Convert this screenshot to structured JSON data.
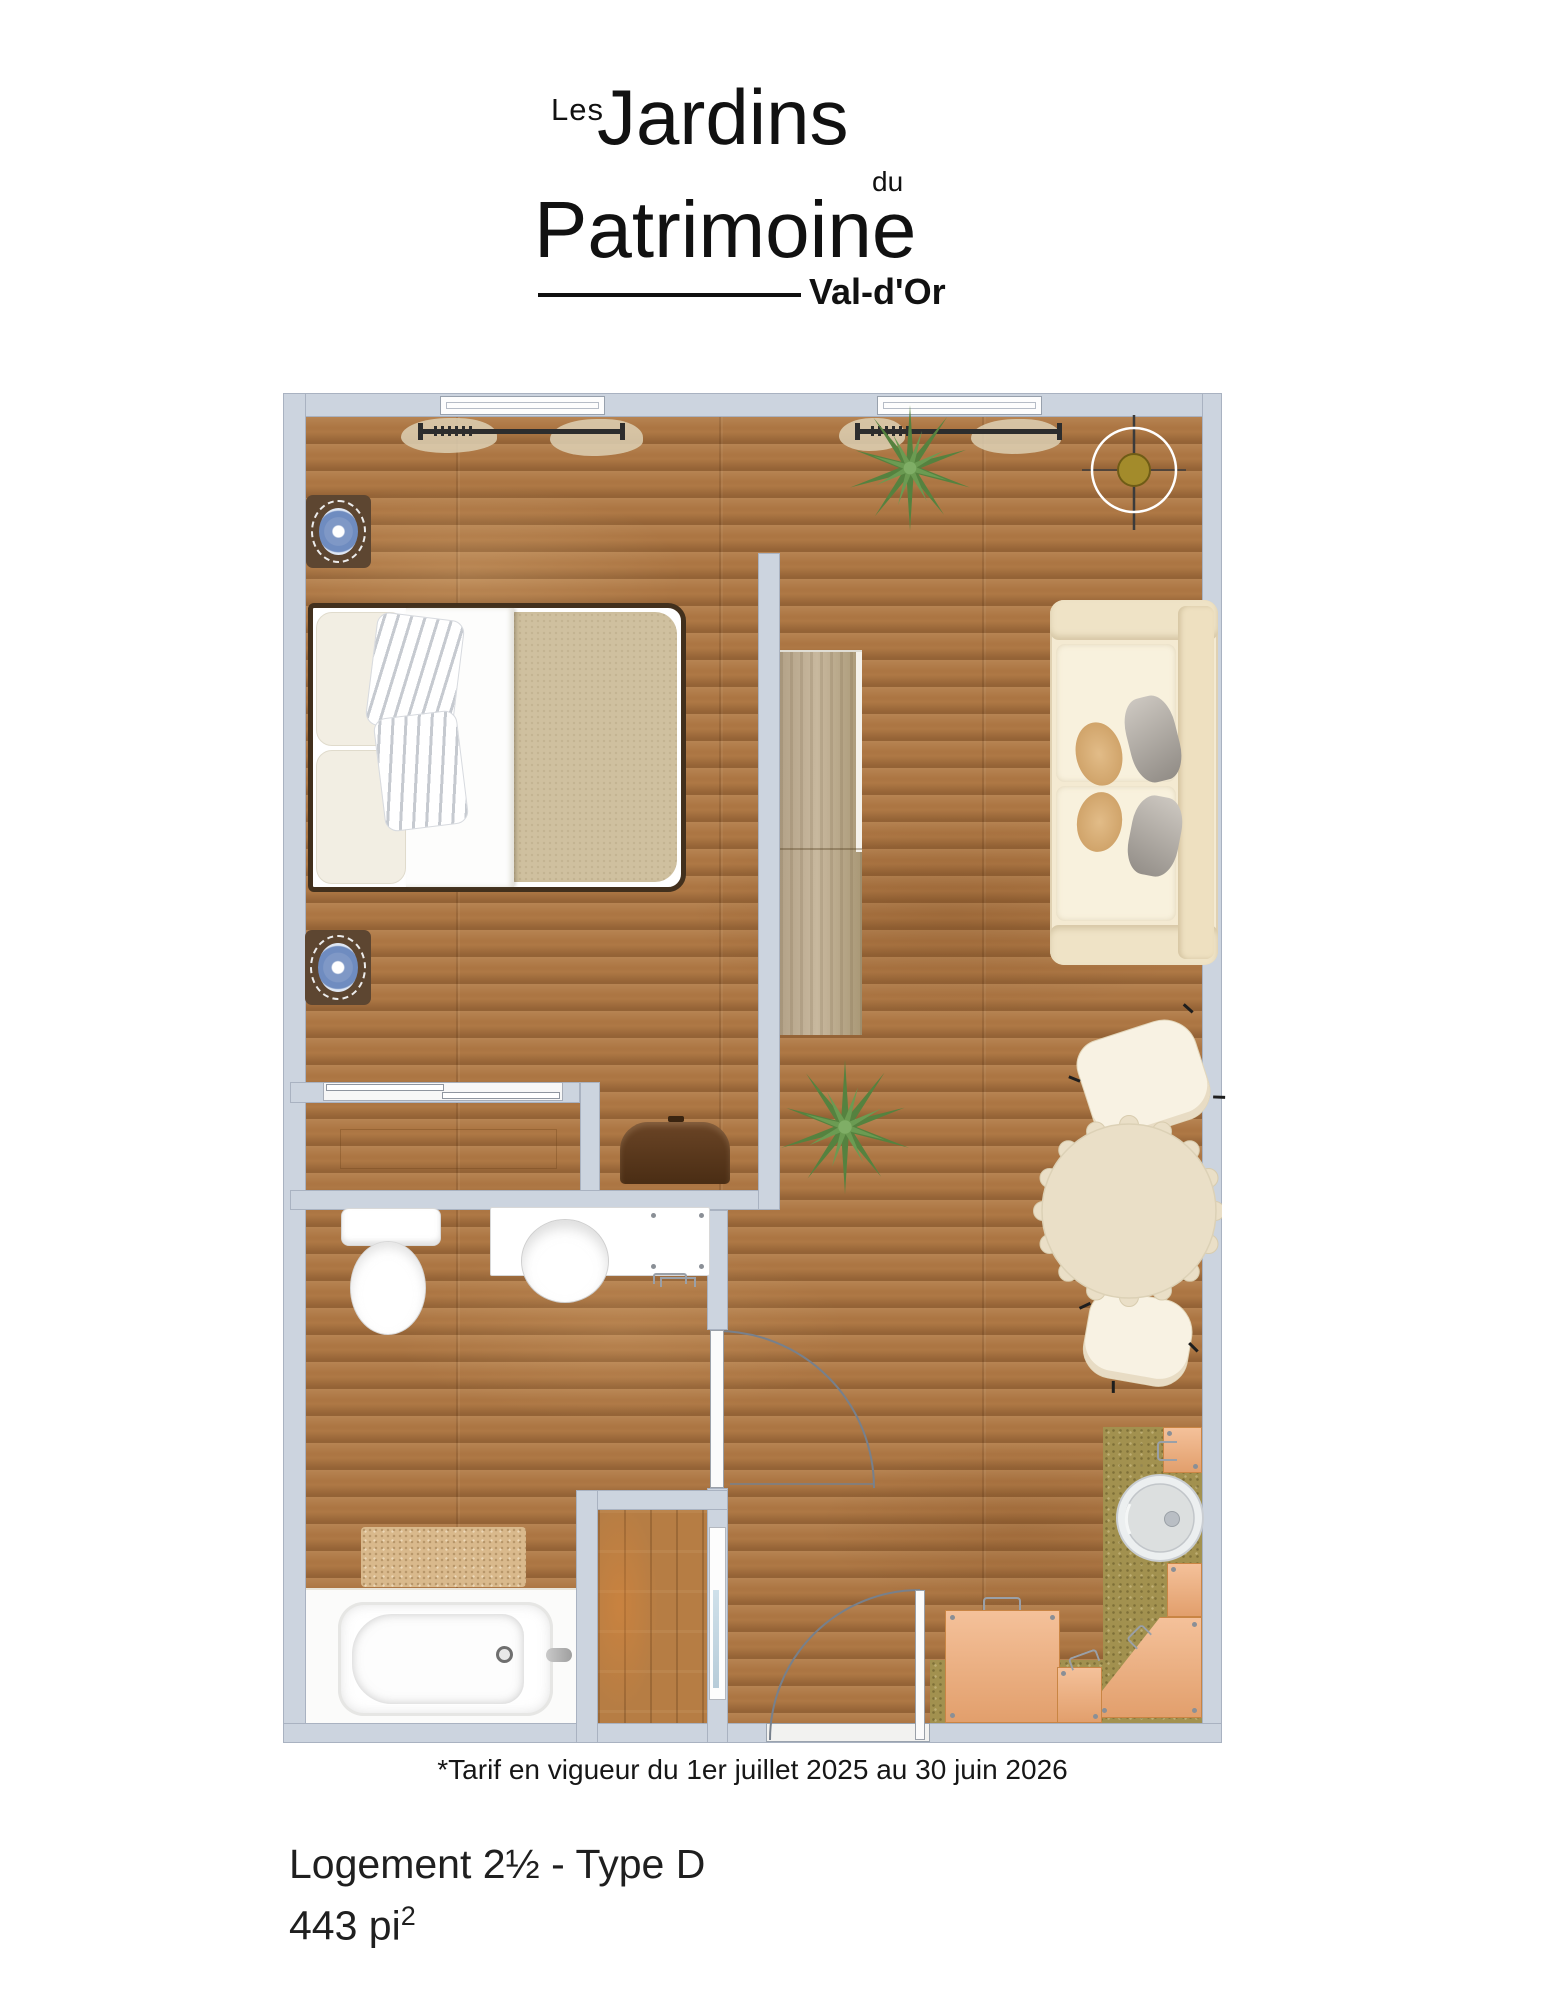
{
  "logo": {
    "les": "Les",
    "jardins": "Jardins",
    "du": "du",
    "patrimoine": "Patrimoine",
    "city": "Val-d'Or"
  },
  "notes": {
    "tarif": "*Tarif en vigueur du 1er juillet 2025 au 30 juin 2026"
  },
  "unit": {
    "title": "Logement 2½ - Type D",
    "area": "443 pi",
    "area_exp": "2"
  },
  "floorplan": {
    "furniture": [
      "bed",
      "nightstand",
      "wardrobe",
      "sofa",
      "dining-table",
      "dining-chair",
      "desk-chair",
      "toilet",
      "sink-vanity",
      "washer",
      "bathtub",
      "bath-mat",
      "kitchen-counter",
      "kitchen-sink",
      "plant",
      "ceiling-light",
      "window",
      "curtain-rod",
      "entry-door",
      "bathroom-door",
      "sliding-door",
      "storage-closet"
    ],
    "colors": {
      "wall": "#ccd4df",
      "wall-edge": "#a9b2c1",
      "floor": "#ae7845",
      "khaki": "#a2914f",
      "counter": "#f0a973",
      "counter-edge": "#c98544",
      "cream": "#f4ead2",
      "table": "#eadfc7",
      "blanket": "#cfc09f",
      "mat": "#d9b98c",
      "wood-dark": "#5d4631",
      "chair-brown": "#5f3c1e",
      "wardrobe": "#bcab90",
      "plant": "#55823f",
      "plant-light": "#6b9b52",
      "plate-blue": "#7f98c6",
      "accent-olive": "#a38b2b",
      "curtain": "#ddd0b4",
      "line": "#77808c",
      "text": "#1c1c1c"
    }
  }
}
